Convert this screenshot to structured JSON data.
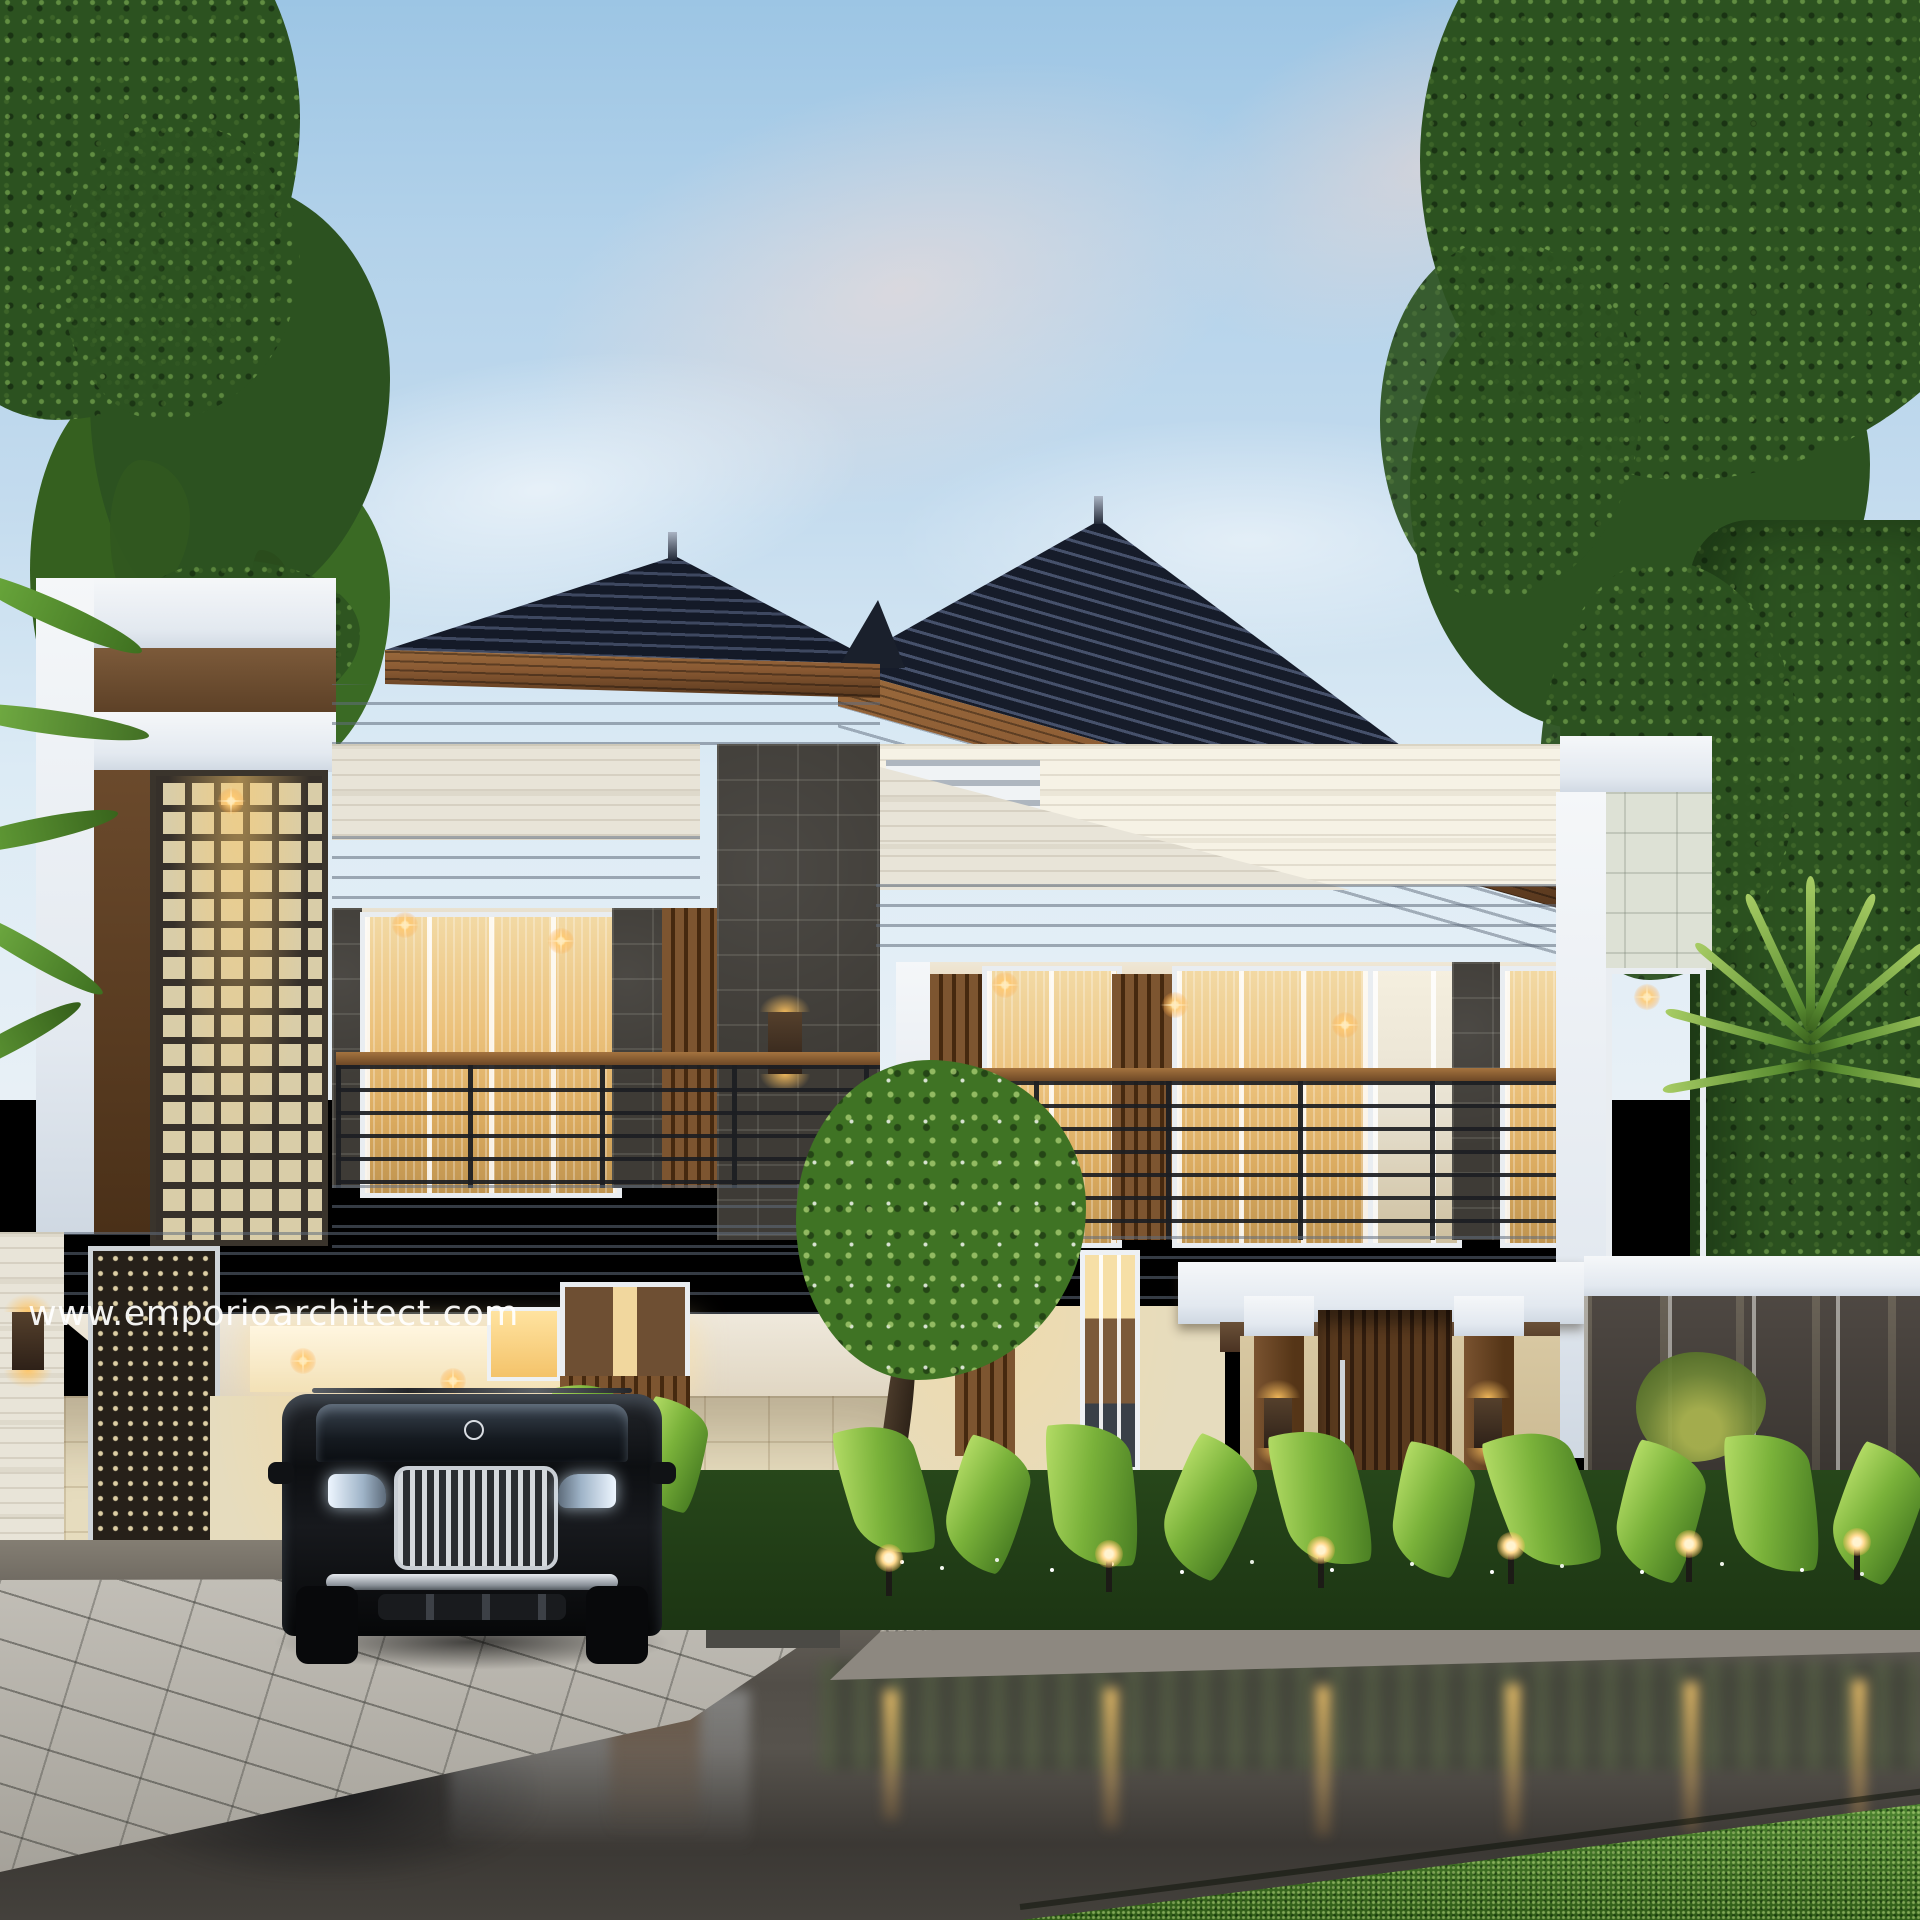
{
  "watermark": {
    "text": "www.emporioarchitect.com"
  },
  "scene": {
    "type": "architectural-exterior-3d-render",
    "time_of_day": "dusk",
    "subject": "modern two-storey tropical villa with dark hip roof, travertine and lava-stone facade, wood slat accents, two balconies, carport with black luxury SUV, lush garden and wet street reflection",
    "garden_light_count": 6
  },
  "palette": {
    "sky_top": "#9cc5e4",
    "sky_mid": "#c3dbee",
    "sky_low": "#e8f0f6",
    "cloud_pink": "#f2d8cf",
    "roof_hi": "#46516b",
    "roof_dark": "#161c2a",
    "fascia_wood": "#8a5a33",
    "wood": "#7d5530",
    "wood_dark": "#46290f",
    "white": "#f5f7f9",
    "travertine": "#e8e4d8",
    "limestone": "#e6dcbe",
    "lava": "#3e3b36",
    "glass_warm": "#ecc27c",
    "glow": "#ffd98e",
    "leaf_dark": "#2c5220",
    "leaf_mid": "#4a7d2d",
    "leaf_bright": "#84bb41",
    "grass": "#3e7a1e",
    "paver": "#b7b3aa",
    "gravel": "#a49f94",
    "road": "#57534d",
    "watermark_color": "#ffffff"
  }
}
